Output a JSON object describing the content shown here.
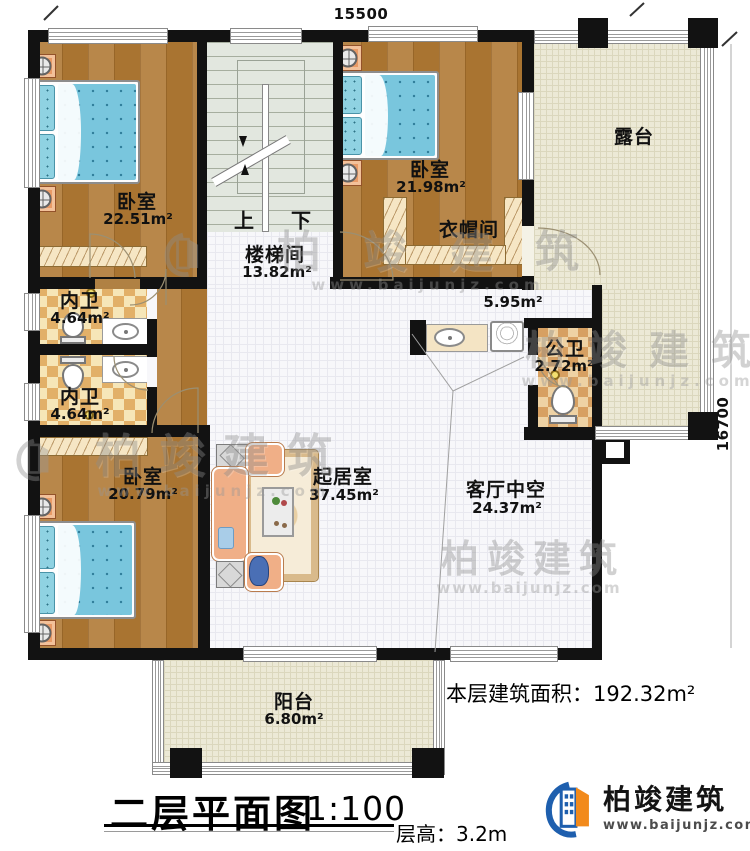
{
  "dimensions": {
    "top": "15500",
    "right": "16700"
  },
  "rooms": {
    "bedroom_tl": {
      "name": "卧室",
      "area": "22.51m²"
    },
    "stairwell": {
      "name": "楼梯间",
      "area": "13.82m²",
      "up": "上",
      "down": "下"
    },
    "bedroom_tr": {
      "name": "卧室",
      "area": "21.98m²"
    },
    "closet": {
      "name": "衣帽间"
    },
    "terrace": {
      "name": "露台"
    },
    "bath_inner_1": {
      "name": "内卫",
      "area": "4.64m²"
    },
    "bath_inner_2": {
      "name": "内卫",
      "area": "4.64m²"
    },
    "hallway": {
      "area": "5.95m²"
    },
    "bath_public": {
      "name": "公卫",
      "area": "2.72m²"
    },
    "bedroom_bl": {
      "name": "卧室",
      "area": "20.79m²"
    },
    "living": {
      "name": "起居室",
      "area": "37.45m²"
    },
    "void": {
      "name": "客厅中空",
      "area": "24.37m²"
    },
    "balcony": {
      "name": "阳台",
      "area": "6.80m²"
    }
  },
  "footer": {
    "title": "二层平面图",
    "scale": "1:100",
    "floor_height": "层高：3.2m",
    "area_note": "本层建筑面积：192.32m²"
  },
  "logo": {
    "brand": "柏竣建筑",
    "url": "www.baijunjz.com"
  },
  "watermark": {
    "brand": "柏竣建筑",
    "url": "www.baijunjz.com"
  },
  "colors": {
    "wall": "#121212",
    "logo_blue": "#1e5fae",
    "logo_orange": "#f28a1b"
  }
}
